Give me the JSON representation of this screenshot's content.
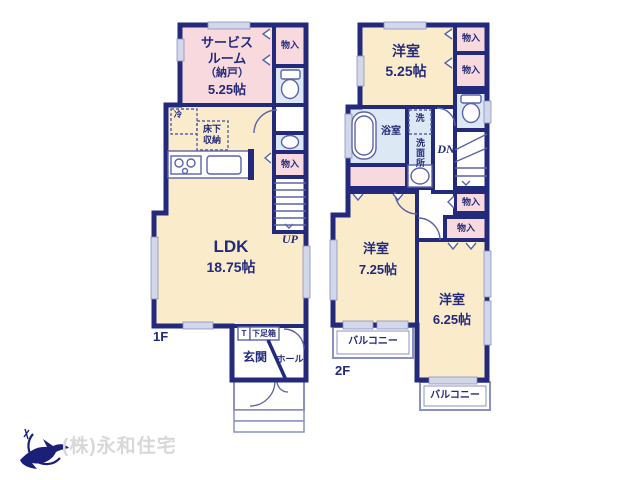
{
  "floor1": {
    "label": "1F",
    "service_room": {
      "line1": "サービス",
      "line2": "ルーム",
      "line3": "（納戸）",
      "area": "5.25帖"
    },
    "ldk": {
      "name": "LDK",
      "area": "18.75帖"
    },
    "closet_upper": "物入",
    "closet_lower": "物入",
    "fridge": "冷",
    "floor_storage_line1": "床下",
    "floor_storage_line2": "収納",
    "stairs": "UP",
    "shoe_t": "T",
    "shoe_box": "下足箱",
    "entrance": "玄関",
    "hall": "ホール"
  },
  "floor2": {
    "label": "2F",
    "bedroom_a": {
      "name": "洋室",
      "area": "5.25帖"
    },
    "bedroom_b": {
      "name": "洋室",
      "area": "7.25帖"
    },
    "bedroom_c": {
      "name": "洋室",
      "area": "6.25帖"
    },
    "bath": "浴室",
    "washer": "洗",
    "washroom": "洗面所",
    "closet_1": "物入",
    "closet_2": "物入",
    "closet_3": "物入",
    "closet_4": "物入",
    "stairs": "DN",
    "balcony_a": "バルコニー",
    "balcony_b": "バルコニー"
  },
  "footer": {
    "company": "(株)永和住宅"
  },
  "colors": {
    "wall": "#232a7c",
    "room_pink": "#f8dade",
    "room_cream": "#faeccb",
    "room_blue": "#dce9f5",
    "fixture_stroke": "#5b63a8",
    "window_fill": "#d2d7ea",
    "outdoor_stroke": "#8a90c0",
    "logo_navy": "#1a1f78",
    "logo_text_gray": "#d8d8d8"
  }
}
